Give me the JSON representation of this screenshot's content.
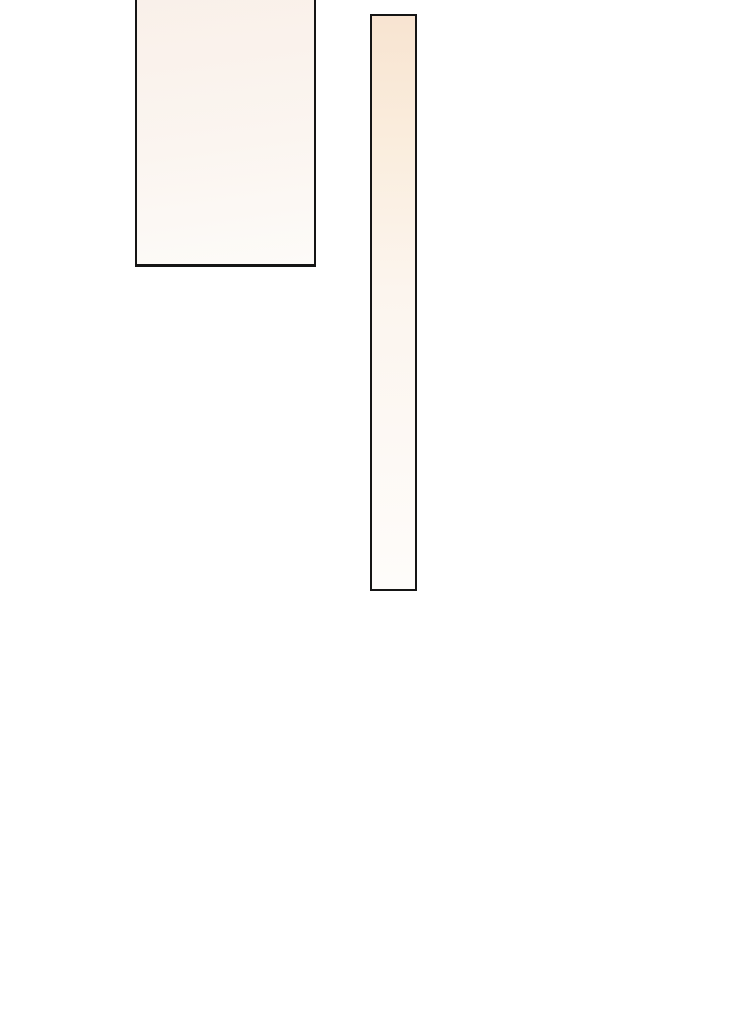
{
  "page": {
    "kind": "blank comic page segment",
    "description": "White page area containing two empty comic panels with black outlines and soft warm gradient fills; no text, icons, or controls are visible"
  },
  "colors": {
    "page-bg": "#ffffff",
    "panel-border": "#151515",
    "panel-a-top": "#f9f0e9",
    "panel-a-mid": "#fbf5f0",
    "panel-a-bottom": "#fdfbf8",
    "panel-b-top": "#f8e4d1",
    "panel-b-upper": "#faeddd",
    "panel-b-mid": "#fcf5ee",
    "panel-b-bottom": "#fefcfa"
  },
  "panels": [
    {
      "id": "panel-large",
      "shape": "rectangle",
      "border": "black, ~2px",
      "fill": "pale cream gradient, darker at top fading to near-white at bottom",
      "note": "top edge cropped by viewport; no visible top border",
      "text": ""
    },
    {
      "id": "panel-tall-thin",
      "shape": "tall narrow rectangle",
      "border": "black, ~2px",
      "fill": "peach at top fading vertically to near-white at bottom",
      "text": ""
    }
  ]
}
